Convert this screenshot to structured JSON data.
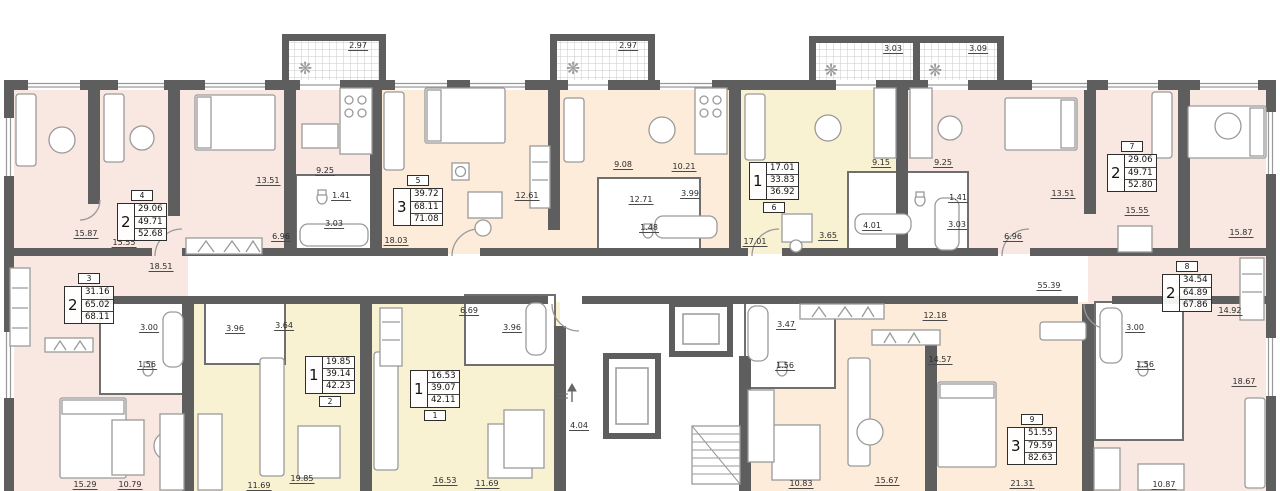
{
  "plan": {
    "type": "residential-floor-plan",
    "colors": {
      "wall": "#5e5e5e",
      "room_pink": "#f9e8e1",
      "room_peach": "#fcecd9",
      "room_yellow": "#f9f2d2",
      "bath_white": "#ffffff",
      "line": "#9a9a9a",
      "text": "#2b2b2b"
    },
    "apartments": [
      {
        "id": "1",
        "rooms": "1",
        "areas": [
          "16.53",
          "39.07",
          "42.11"
        ],
        "x": 410,
        "y": 370,
        "badge_below": true
      },
      {
        "id": "2",
        "rooms": "1",
        "areas": [
          "19.85",
          "39.14",
          "42.23"
        ],
        "x": 305,
        "y": 356,
        "badge_below": true
      },
      {
        "id": "3",
        "rooms": "2",
        "areas": [
          "31.16",
          "65.02",
          "68.11"
        ],
        "x": 64,
        "y": 273,
        "badge_below": false
      },
      {
        "id": "4",
        "rooms": "2",
        "areas": [
          "29.06",
          "49.71",
          "52.68"
        ],
        "x": 117,
        "y": 190,
        "badge_below": false
      },
      {
        "id": "5",
        "rooms": "3",
        "areas": [
          "39.72",
          "68.11",
          "71.08"
        ],
        "x": 393,
        "y": 175,
        "badge_below": false
      },
      {
        "id": "6",
        "rooms": "1",
        "areas": [
          "17.01",
          "33.83",
          "36.92"
        ],
        "x": 749,
        "y": 162,
        "badge_below": true
      },
      {
        "id": "7",
        "rooms": "2",
        "areas": [
          "29.06",
          "49.71",
          "52.80"
        ],
        "x": 1107,
        "y": 141,
        "badge_below": false
      },
      {
        "id": "8",
        "rooms": "2",
        "areas": [
          "34.54",
          "64.89",
          "67.86"
        ],
        "x": 1162,
        "y": 261,
        "badge_below": false
      },
      {
        "id": "9",
        "rooms": "3",
        "areas": [
          "51.55",
          "79.59",
          "82.63"
        ],
        "x": 1007,
        "y": 414,
        "badge_below": false
      }
    ],
    "dimensions": [
      {
        "t": "2.97",
        "x": 358,
        "y": 41
      },
      {
        "t": "2.97",
        "x": 628,
        "y": 41
      },
      {
        "t": "3.03",
        "x": 893,
        "y": 44
      },
      {
        "t": "3.09",
        "x": 978,
        "y": 44
      },
      {
        "t": "15.87",
        "x": 86,
        "y": 229
      },
      {
        "t": "15.55",
        "x": 124,
        "y": 238
      },
      {
        "t": "13.51",
        "x": 268,
        "y": 176
      },
      {
        "t": "9.25",
        "x": 325,
        "y": 166
      },
      {
        "t": "1.41",
        "x": 341,
        "y": 191
      },
      {
        "t": "3.03",
        "x": 334,
        "y": 219
      },
      {
        "t": "6.96",
        "x": 281,
        "y": 232
      },
      {
        "t": "18.03",
        "x": 396,
        "y": 236
      },
      {
        "t": "12.61",
        "x": 527,
        "y": 191
      },
      {
        "t": "9.08",
        "x": 623,
        "y": 160
      },
      {
        "t": "10.21",
        "x": 684,
        "y": 162
      },
      {
        "t": "12.71",
        "x": 641,
        "y": 195
      },
      {
        "t": "3.99",
        "x": 690,
        "y": 189
      },
      {
        "t": "1.48",
        "x": 649,
        "y": 223
      },
      {
        "t": "17.01",
        "x": 755,
        "y": 237
      },
      {
        "t": "3.65",
        "x": 828,
        "y": 231
      },
      {
        "t": "4.01",
        "x": 872,
        "y": 221
      },
      {
        "t": "1.41",
        "x": 958,
        "y": 193
      },
      {
        "t": "3.03",
        "x": 957,
        "y": 220
      },
      {
        "t": "9.15",
        "x": 881,
        "y": 158
      },
      {
        "t": "9.25",
        "x": 943,
        "y": 158
      },
      {
        "t": "6.96",
        "x": 1013,
        "y": 232
      },
      {
        "t": "13.51",
        "x": 1063,
        "y": 189
      },
      {
        "t": "15.55",
        "x": 1137,
        "y": 206
      },
      {
        "t": "15.87",
        "x": 1241,
        "y": 228
      },
      {
        "t": "18.51",
        "x": 161,
        "y": 262
      },
      {
        "t": "55.39",
        "x": 1049,
        "y": 281
      },
      {
        "t": "3.00",
        "x": 149,
        "y": 323
      },
      {
        "t": "1.56",
        "x": 147,
        "y": 360
      },
      {
        "t": "3.96",
        "x": 235,
        "y": 324
      },
      {
        "t": "3.64",
        "x": 284,
        "y": 321
      },
      {
        "t": "6.69",
        "x": 469,
        "y": 306
      },
      {
        "t": "3.96",
        "x": 512,
        "y": 323
      },
      {
        "t": "3.47",
        "x": 786,
        "y": 320
      },
      {
        "t": "1.56",
        "x": 785,
        "y": 361
      },
      {
        "t": "12.18",
        "x": 935,
        "y": 311
      },
      {
        "t": "14.57",
        "x": 940,
        "y": 355
      },
      {
        "t": "3.00",
        "x": 1135,
        "y": 323
      },
      {
        "t": "1.56",
        "x": 1145,
        "y": 360
      },
      {
        "t": "14.92",
        "x": 1230,
        "y": 306
      },
      {
        "t": "18.67",
        "x": 1244,
        "y": 377
      },
      {
        "t": "4.04",
        "x": 579,
        "y": 421
      },
      {
        "t": "10.83",
        "x": 801,
        "y": 479
      },
      {
        "t": "15.29",
        "x": 85,
        "y": 480
      },
      {
        "t": "10.79",
        "x": 130,
        "y": 480
      },
      {
        "t": "11.69",
        "x": 259,
        "y": 481
      },
      {
        "t": "19.85",
        "x": 302,
        "y": 474
      },
      {
        "t": "16.53",
        "x": 445,
        "y": 476
      },
      {
        "t": "11.69",
        "x": 487,
        "y": 479
      },
      {
        "t": "15.67",
        "x": 887,
        "y": 476
      },
      {
        "t": "21.31",
        "x": 1022,
        "y": 479
      },
      {
        "t": "10.87",
        "x": 1164,
        "y": 480
      }
    ]
  }
}
